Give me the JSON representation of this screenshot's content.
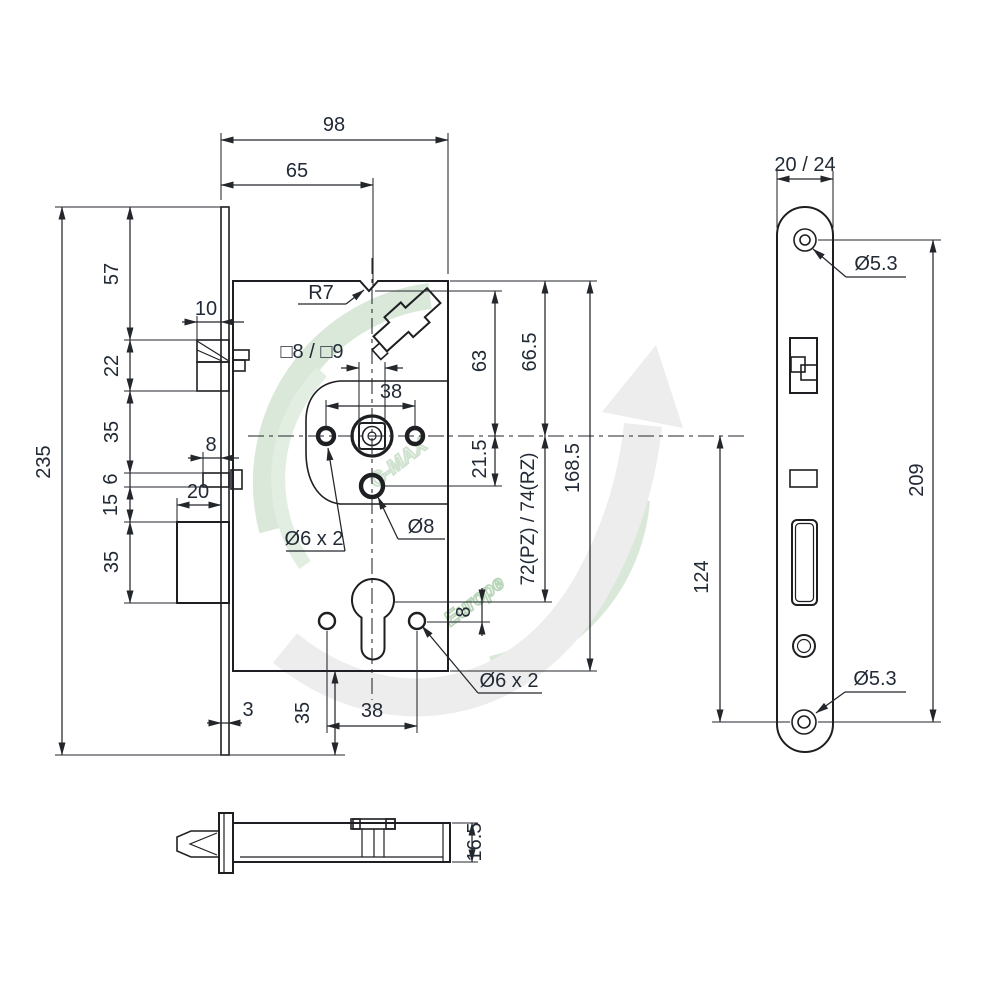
{
  "watermark": {
    "brand": "G-MAX",
    "region": "Europe"
  },
  "colors": {
    "line": "#1e1f22",
    "text": "#222a36",
    "watermark_green": "#d6e7d6",
    "watermark_green_dark": "#bdd8bd",
    "watermark_gray": "#ececec",
    "background": "#ffffff"
  },
  "main_view": {
    "title": "lock-case-front-view",
    "dims": {
      "depth_total": "98",
      "backset": "65",
      "notch_radius": "R7",
      "latch_protrusion": "10",
      "height_total": "235",
      "seg_top": "57",
      "seg_latch": "22",
      "seg_mid": "35",
      "seg_stub": "6",
      "seg_gap": "15",
      "seg_bolt": "35",
      "bolt_protrusion": "8",
      "bolt_throw": "20",
      "spindle_square": "□8 / □9",
      "follower_hole_spacing": "38",
      "notch_to_axis": "63",
      "top_to_axis": "66.5",
      "axis_to_hole": "21.5",
      "case_height": "168.5",
      "centre_distance": "72(PZ) / 74(RZ)",
      "fix_holes_top": "Ø6 x 2",
      "hole_mid": "Ø8",
      "axis_offset": "8",
      "fix_holes_bottom": "Ø6 x 2",
      "plate_thickness": "3",
      "case_to_plate_end": "35",
      "cyl_hole_spacing": "38"
    }
  },
  "faceplate_view": {
    "title": "faceplate-view",
    "dims": {
      "width": "20 / 24",
      "screw_hole_top": "Ø5.3",
      "screw_hole_bottom": "Ø5.3",
      "screw_spacing": "209",
      "axis_to_screw": "124"
    }
  },
  "bottom_view": {
    "title": "lock-bottom-view",
    "dims": {
      "case_thickness": "16.5"
    }
  }
}
